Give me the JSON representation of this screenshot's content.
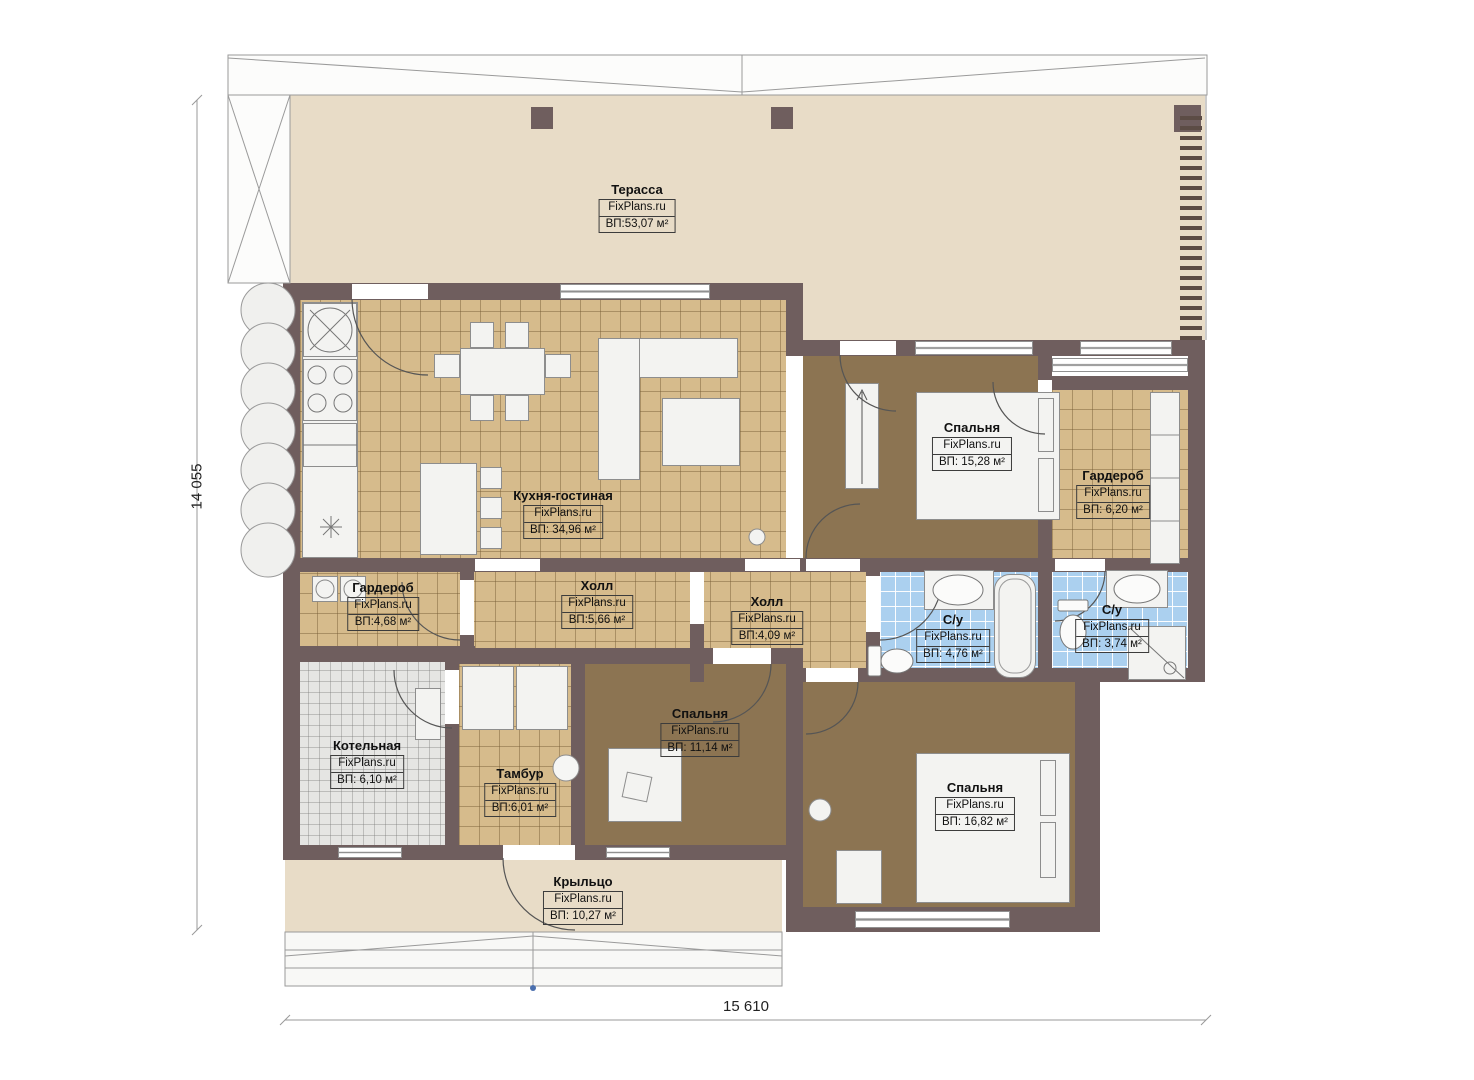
{
  "site_watermark": "FixPlans.ru",
  "dimensions": {
    "vertical": "14 055",
    "horizontal": "15 610"
  },
  "colors": {
    "wall": "#6f5e5e",
    "terrace_floor": "#e8dcc7",
    "tile_tan": "#d6bb8c",
    "tile_blue": "#abd0ef",
    "tile_gray": "#e5e5e3",
    "bedroom_floor": "#8c7452"
  },
  "rooms": {
    "terrace": {
      "name": "Терасса",
      "brand": "FixPlans.ru",
      "area": "ВП:53,07 м²"
    },
    "kitchen_living": {
      "name": "Кухня-гостиная",
      "brand": "FixPlans.ru",
      "area": "ВП: 34,96 м²"
    },
    "bedroom_1": {
      "name": "Спальня",
      "brand": "FixPlans.ru",
      "area": "ВП: 15,28 м²"
    },
    "wardrobe_1": {
      "name": "Гардероб",
      "brand": "FixPlans.ru",
      "area": "ВП: 6,20 м²"
    },
    "hall_1": {
      "name": "Холл",
      "brand": "FixPlans.ru",
      "area": "ВП:5,66 м²"
    },
    "hall_2": {
      "name": "Холл",
      "brand": "FixPlans.ru",
      "area": "ВП:4,09 м²"
    },
    "bathroom_1": {
      "name": "С/у",
      "brand": "FixPlans.ru",
      "area": "ВП: 4,76 м²"
    },
    "bathroom_2": {
      "name": "С/у",
      "brand": "FixPlans.ru",
      "area": "ВП: 3,74 м²"
    },
    "wardrobe_2": {
      "name": "Гардероб",
      "brand": "FixPlans.ru",
      "area": "ВП:4,68 м²"
    },
    "boiler": {
      "name": "Котельная",
      "brand": "FixPlans.ru",
      "area": "ВП: 6,10 м²"
    },
    "tambour": {
      "name": "Тамбур",
      "brand": "FixPlans.ru",
      "area": "ВП:6,01 м²"
    },
    "bedroom_2": {
      "name": "Спальня",
      "brand": "FixPlans.ru",
      "area": "ВП: 11,14 м²"
    },
    "bedroom_3": {
      "name": "Спальня",
      "brand": "FixPlans.ru",
      "area": "ВП: 16,82 м²"
    },
    "porch": {
      "name": "Крыльцо",
      "brand": "FixPlans.ru",
      "area": "ВП: 10,27 м²"
    }
  }
}
